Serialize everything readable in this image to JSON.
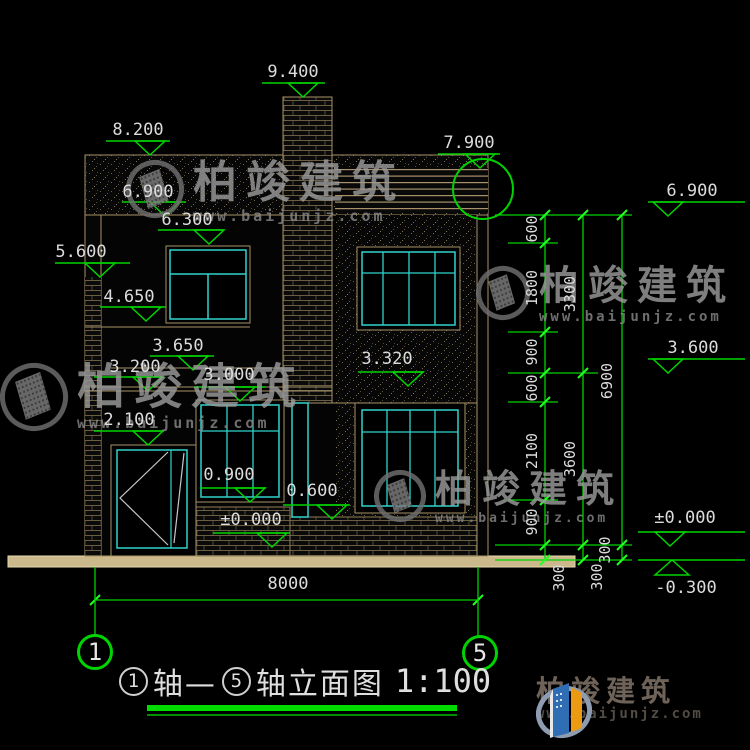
{
  "colors": {
    "background": "#000000",
    "dim_green": "#00d400",
    "text_white": "#dcdcdc",
    "wall_tan": "#a89265",
    "window_cyan": "#31d2cc",
    "slab_fill": "#cbb98b",
    "watermark_gray": "#9a9a9a",
    "logo_blue": "#2f6db4",
    "logo_orange": "#ec9a12"
  },
  "levels": {
    "v9400": "9.400",
    "v8200": "8.200",
    "v7900": "7.900",
    "v6900_left": "6.900",
    "v6300": "6.300",
    "v5600": "5.600",
    "v4650": "4.650",
    "v3650": "3.650",
    "v3200": "3.200",
    "v3000": "3.000",
    "v3320": "3.320",
    "v2100": "2.100",
    "v0900": "0.900",
    "v0600": "0.600",
    "v0000_left": "±0.000",
    "v6900_right": "6.900",
    "v3600_right": "3.600",
    "v0000_right": "±0.000",
    "vm0300_right": "-0.300"
  },
  "chain": {
    "col1": [
      "600",
      "1800",
      "900",
      "600",
      "2100",
      "900",
      "300"
    ],
    "col2": [
      "3300",
      "3600",
      "300"
    ],
    "col3": [
      "6900",
      "300"
    ]
  },
  "bottom": {
    "overall_width": "8000",
    "axis_left": "1",
    "axis_right": "5"
  },
  "title": {
    "axis1": "1",
    "mid": "轴—",
    "axis2": "5",
    "suffix": "轴立面图",
    "scale": "1:100"
  },
  "watermark": {
    "brand": "柏竣建筑",
    "url": "www.baijunjz.com"
  },
  "logo": {
    "brand": "柏竣建筑",
    "url": "www.baijunjz.com"
  }
}
